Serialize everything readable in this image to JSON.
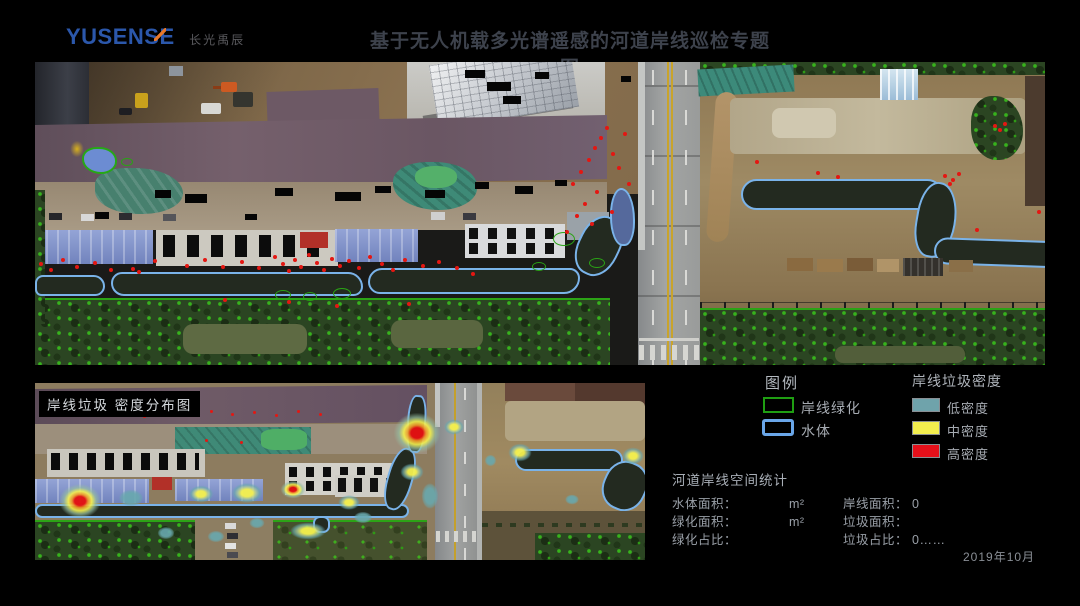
{
  "header": {
    "logo_text": "YUSENSE",
    "logo_cn": "长光禹辰",
    "title": "基于无人机载多光谱遥感的河道岸线巡检专题图"
  },
  "inset": {
    "label": "岸线垃圾 密度分布图"
  },
  "legend": {
    "title": "图例",
    "items": [
      {
        "label": "岸线绿化",
        "swatch": "green-outline",
        "color": "#1f9e12"
      },
      {
        "label": "水体",
        "swatch": "blue-outline",
        "color": "#6aa6e8"
      }
    ],
    "density": {
      "title": "岸线垃圾密度",
      "items": [
        {
          "label": "低密度",
          "color": "#6fa3ab"
        },
        {
          "label": "中密度",
          "color": "#f2ee4e"
        },
        {
          "label": "高密度",
          "color": "#e5101a"
        }
      ]
    }
  },
  "stats": {
    "title": "河道岸线空间统计",
    "left": [
      {
        "label": "水体面积：",
        "value": "",
        "unit": "m²"
      },
      {
        "label": "绿化面积：",
        "value": "",
        "unit": "m²"
      },
      {
        "label": "绿化占比：",
        "value": "",
        "unit": ""
      }
    ],
    "right": [
      {
        "label": "岸线面积：",
        "value": "0",
        "unit": ""
      },
      {
        "label": "垃圾面积：",
        "value": "",
        "unit": ""
      },
      {
        "label": "垃圾占比：",
        "value": "0……",
        "unit": ""
      }
    ],
    "date": "2019年10月"
  },
  "map_overlay_colors": {
    "vegetation_outline": "#2aa315",
    "water_outline": "#7ab3e9",
    "garbage_dot": "#e41712"
  }
}
